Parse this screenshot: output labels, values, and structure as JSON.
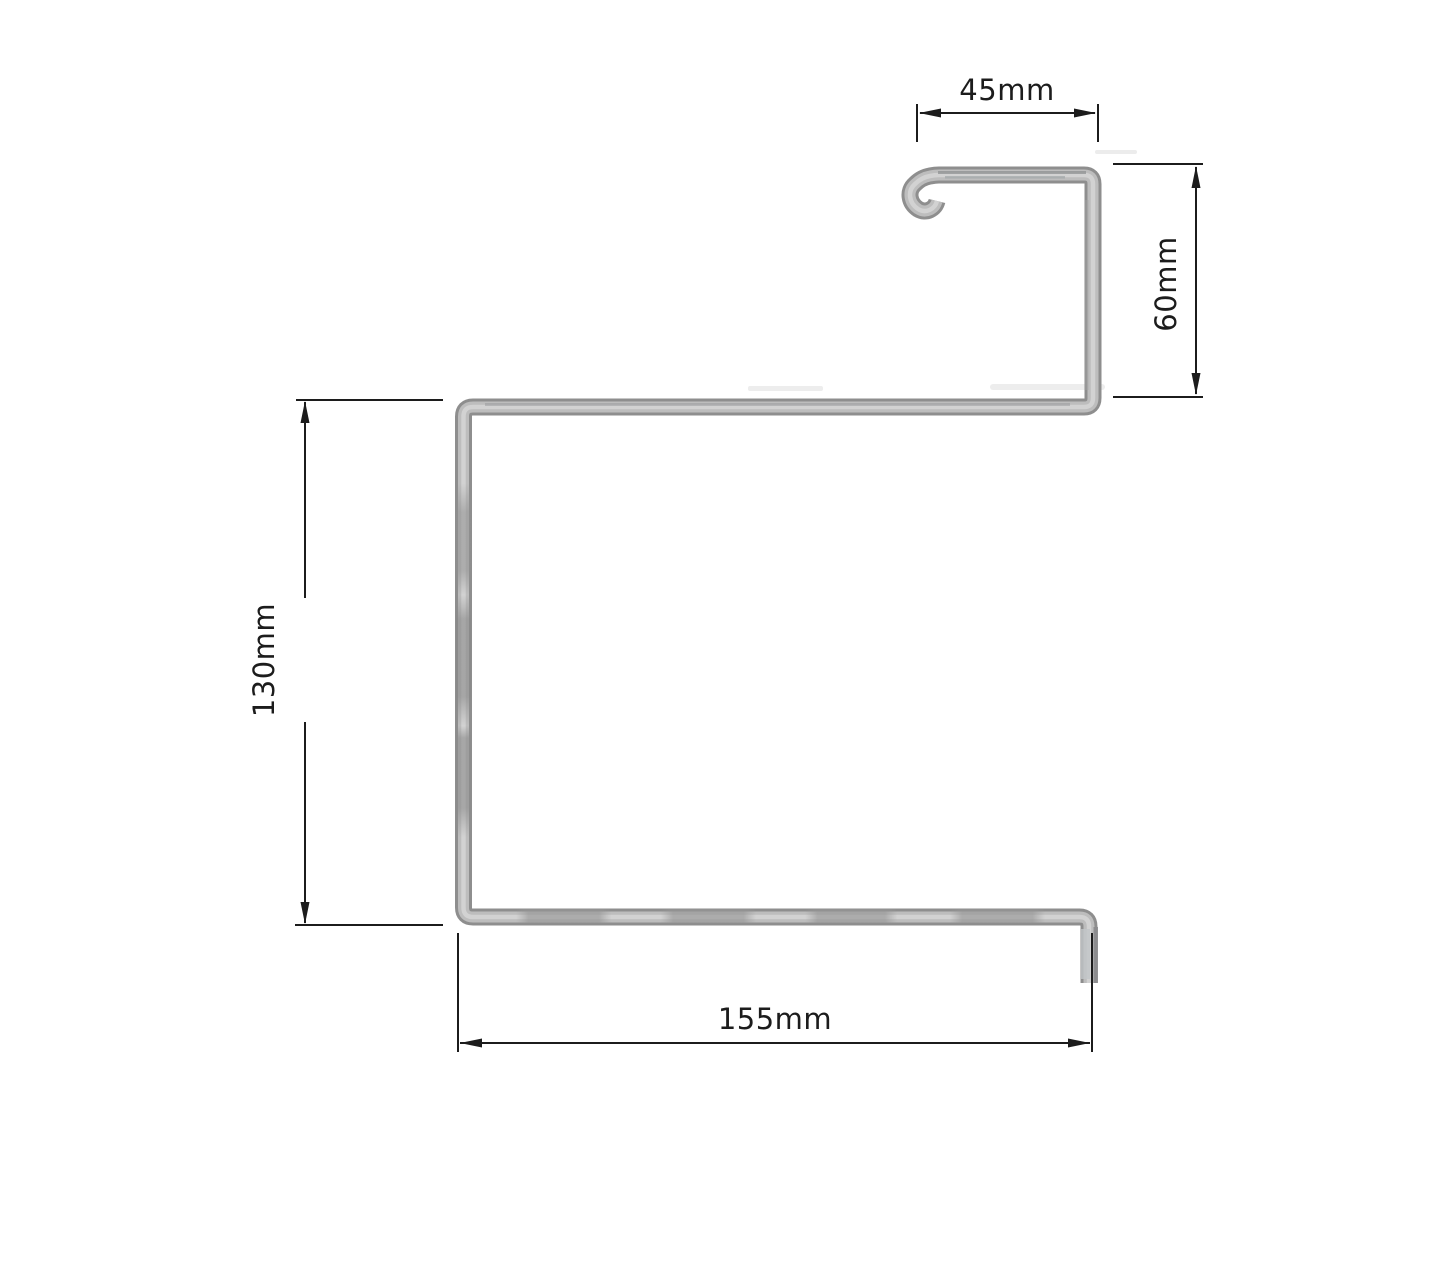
{
  "drawing": {
    "type": "profile-cross-section-technical-drawing",
    "dimensions": {
      "top_width_label": "45mm",
      "right_height_label": "60mm",
      "left_height_label": "130mm",
      "bottom_width_label": "155mm"
    },
    "colors": {
      "background": "#ffffff",
      "annotation": "#1c1c1c",
      "metal_edge": "#8e8e8e",
      "metal_body": "#bdbdbd",
      "metal_highlight": "#d2d2d2"
    }
  }
}
